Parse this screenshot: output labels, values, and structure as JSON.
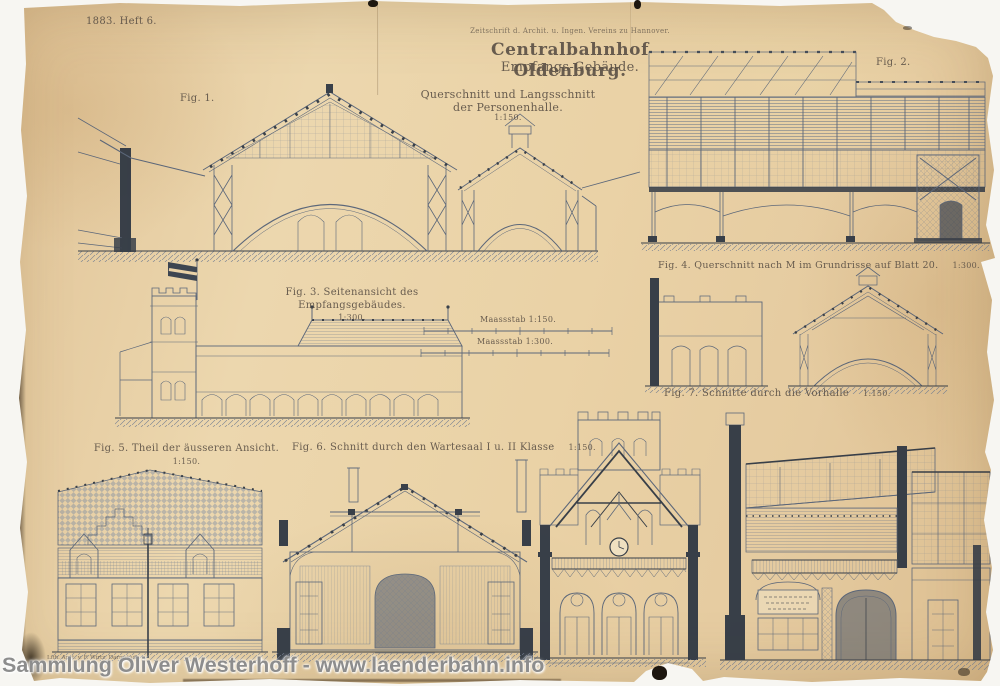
{
  "header": {
    "issue": "1883. Heft 6.",
    "journal_line": "Zeitschrift d. Archit. u. Ingen. Vereins zu Hannover.",
    "title": "Centralbahnhof Oldenburg.",
    "subtitle": "Empfangs-Gebäude.",
    "subject_line1": "Querschnitt und Langsschnitt",
    "subject_line2": "der Personenhalle.",
    "subject_scale": "1:150."
  },
  "figures": {
    "fig1_label": "Fig. 1.",
    "fig2_label": "Fig. 2.",
    "fig3_caption": "Fig. 3. Seitenansicht des Empfangsgebäudes.",
    "fig3_scale": "1:300.",
    "fig4_caption": "Fig. 4. Querschnitt nach M im Grundrisse auf Blatt 20.",
    "fig4_scale": "1:300.",
    "fig5_caption": "Fig. 5. Theil der äusseren Ansicht.",
    "fig5_scale": "1:150.",
    "fig6_caption": "Fig. 6. Schnitt durch den Wartesaal I u. II Klasse",
    "fig6_scale": "1:150.",
    "fig7_caption": "Fig. 7. Schnitte durch die Vorhalle",
    "fig7_scale": "1:150."
  },
  "scale_bars": {
    "bar1_label": "Maassstab 1:150.",
    "bar2_label": "Maassstab 1:300."
  },
  "imprint": "Lith. Anst. v. F. Wirtz, Darmstadt.",
  "watermark": "Sammlung Oliver Westerhoff - www.laenderbahn.info",
  "colors": {
    "paper": "#e9d1a7",
    "ink": "#4d5c75",
    "ink_dark": "#26303f",
    "caption_ink": "#5d5247",
    "watermark_gray": "#8d8d8d"
  }
}
